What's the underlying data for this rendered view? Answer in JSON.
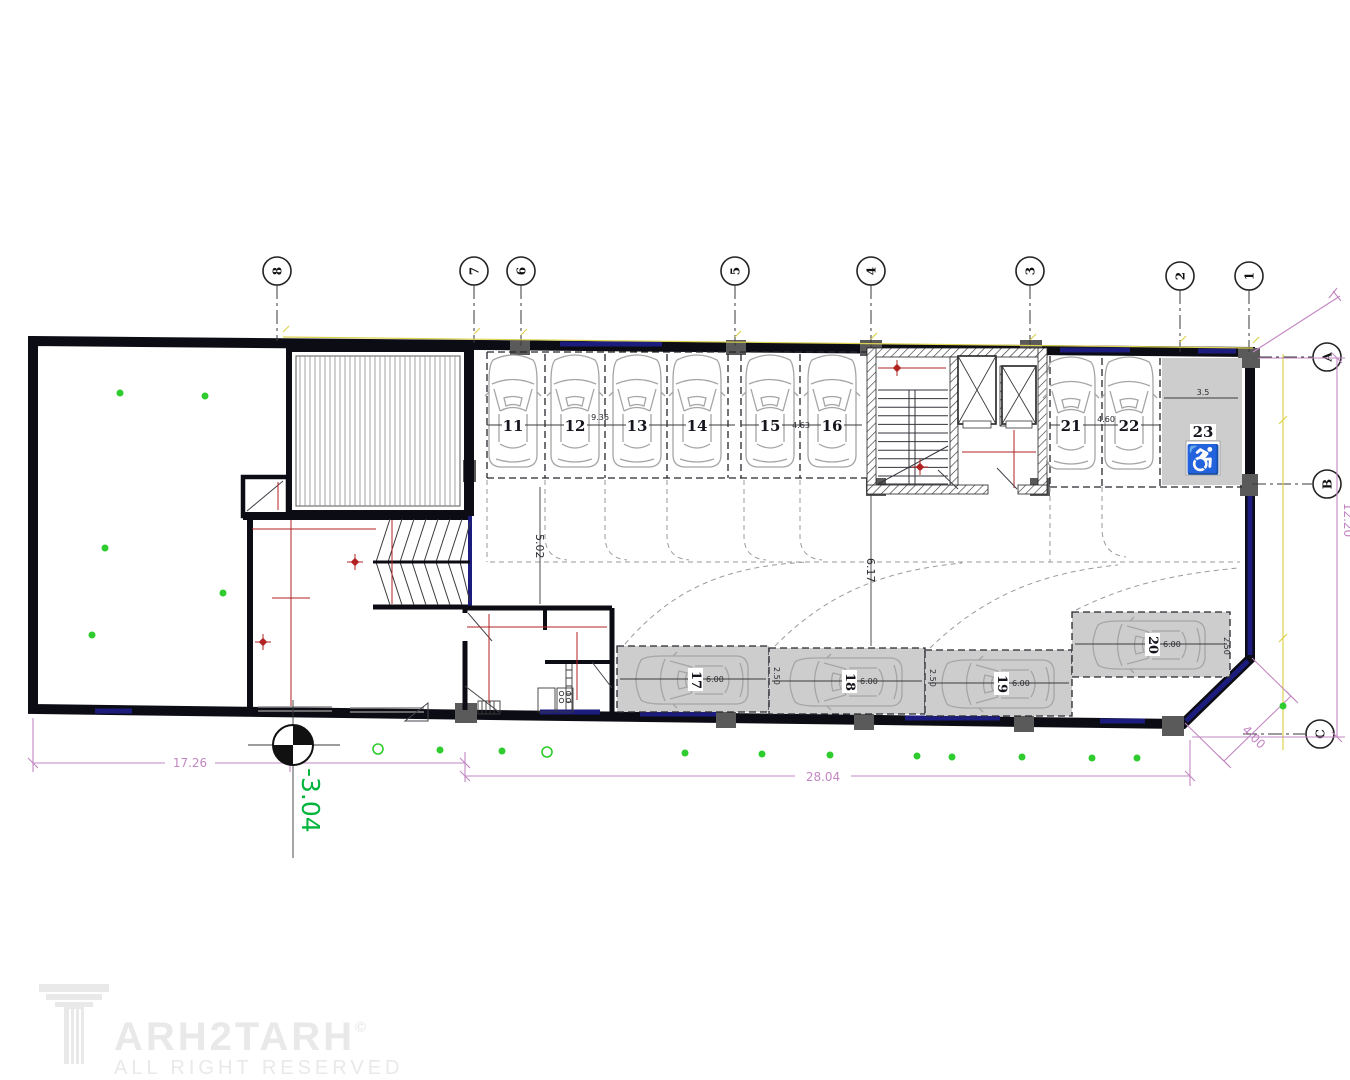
{
  "grid": {
    "top": [
      "8",
      "7",
      "6",
      "5",
      "4",
      "3",
      "2",
      "1"
    ],
    "side": [
      "A",
      "B",
      "C"
    ]
  },
  "parking": {
    "top_row": [
      "11",
      "12",
      "13",
      "14",
      "15",
      "16"
    ],
    "right_row": [
      "21",
      "22"
    ],
    "accessible": "23",
    "bottom_row": [
      "17",
      "18",
      "19",
      "20"
    ]
  },
  "dimensions": {
    "site_left": "17.26",
    "site_bottom": "28.04",
    "site_right": "12.20",
    "corner": "4.00",
    "level": "-3.04",
    "aisle": "5.02",
    "core": "6.17",
    "bays_11_14": "9.36",
    "bay_15_16": "4.63",
    "bay_21_22": "4.60",
    "bay_23": "3.5",
    "stall_length": "6.00",
    "stall_width": "2.50"
  },
  "icons": {
    "wheelchair": "♿"
  },
  "watermark": {
    "brand": "ARH2TARH",
    "copyright": "©",
    "subtitle": "ALL RIGHT RESERVED"
  },
  "colors": {
    "wall": "#0c0c14",
    "navy": "#1c1c7e",
    "yellow": "#ddd24e",
    "pink": "#c287c2",
    "red": "#b22222",
    "green": "#2ecc2e",
    "green_text": "#00b43c",
    "stall": "#cdcdcd",
    "car": "#a5a5a5",
    "column": "#5a5a5a",
    "watermark": "#e9e9e9"
  }
}
